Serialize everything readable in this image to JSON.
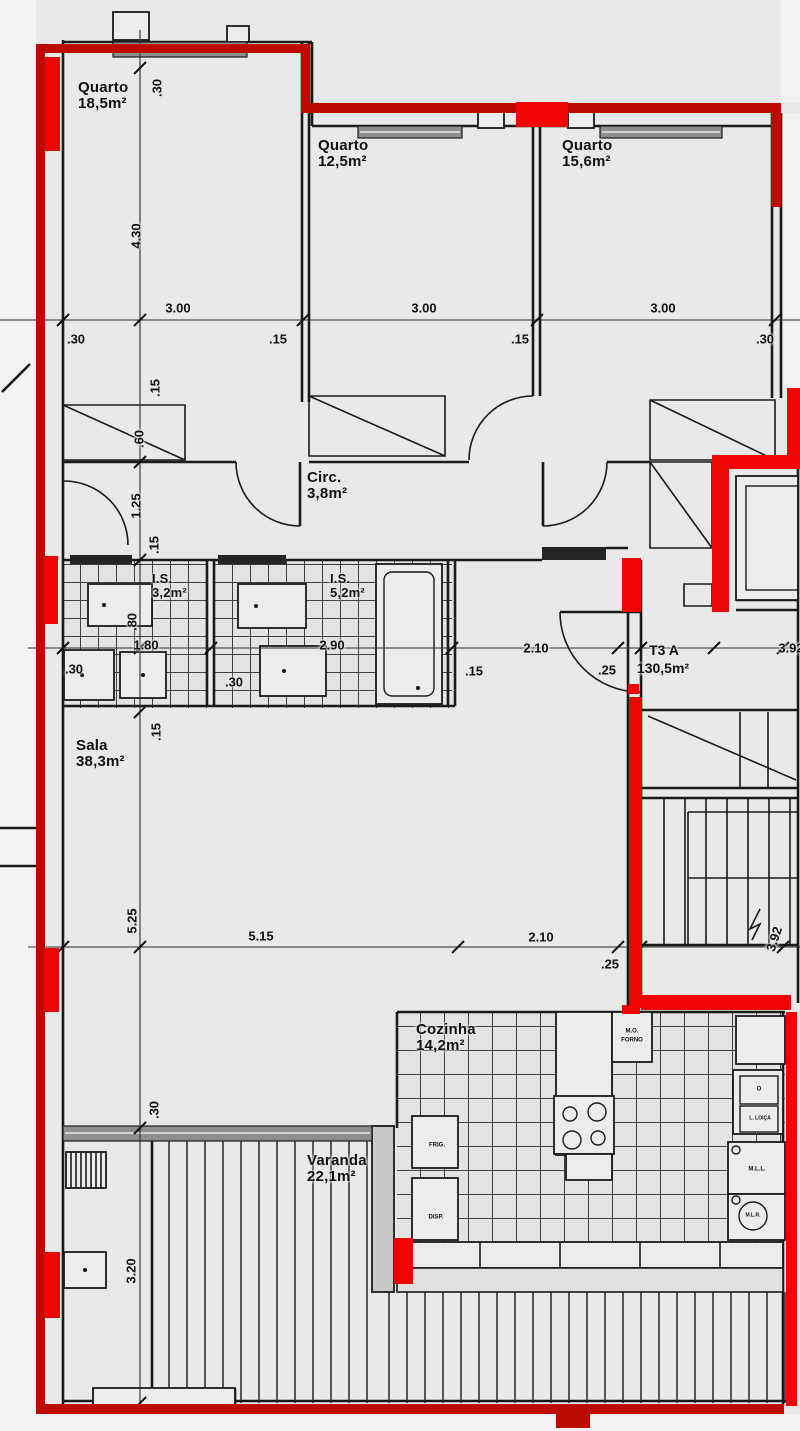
{
  "unit": {
    "code": "T3 A",
    "area": "130,5m²"
  },
  "rooms": [
    {
      "id": "quarto-1",
      "name": "Quarto",
      "area": "18,5m²"
    },
    {
      "id": "quarto-2",
      "name": "Quarto",
      "area": "12,5m²"
    },
    {
      "id": "quarto-3",
      "name": "Quarto",
      "area": "15,6m²"
    },
    {
      "id": "circulacao",
      "name": "Circ.",
      "area": "3,8m²"
    },
    {
      "id": "is-1",
      "name": "I.S.",
      "area": "3,2m²"
    },
    {
      "id": "is-2",
      "name": "I.S.",
      "area": "5,2m²"
    },
    {
      "id": "sala",
      "name": "Sala",
      "area": "38,3m²"
    },
    {
      "id": "cozinha",
      "name": "Cozinha",
      "area": "14,2m²"
    },
    {
      "id": "varanda",
      "name": "Varanda",
      "area": "22,1m²"
    }
  ],
  "appliances": {
    "mo": "M.O.",
    "forno": "FORNO",
    "frig": "FRIG.",
    "disp": "DISP.",
    "oven_o": "O",
    "sink": "L. LOIÇA",
    "mll": "M.L.L.",
    "mlr": "M.L.R."
  },
  "dimensions": {
    "top_above": [
      "3.00",
      "3.00",
      "3.00"
    ],
    "top_below": [
      ".30",
      ".15",
      ".15",
      ".30"
    ],
    "left_chain": [
      ".30",
      "4.30",
      ".15",
      ".60",
      "1.25",
      ".15",
      ".80",
      ".15",
      "5.25",
      ".30",
      "3.20"
    ],
    "mid_above": [
      "1.80",
      "2.90",
      "2.10",
      "3.92"
    ],
    "mid_below": [
      ".30",
      ".30",
      ".15",
      ".25"
    ],
    "bottom_chain": [
      "5.15",
      "2.10",
      ".25",
      "3.92"
    ]
  },
  "colors": {
    "highlight_red": "#ee0400",
    "outline_red": "#bd0a00",
    "wall": "#1a1a1a",
    "paper": "#e9e9e9"
  }
}
